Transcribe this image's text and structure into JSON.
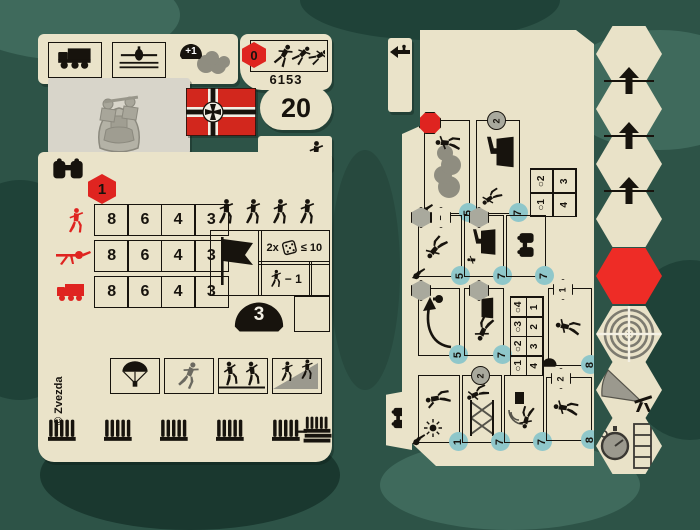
{
  "colors": {
    "background": "#2d5347",
    "camo_dark": "#1f4238",
    "camo_light": "#3f6a5c",
    "card": "#eae3c9",
    "red": "#df2420",
    "flag_red": "#d2271d",
    "ink": "#17130d",
    "teal_badge": "#8fc7ca",
    "icon_gray": "#8f8d80"
  },
  "left_card": {
    "transport_row": {
      "icons": [
        "truck",
        "air-transport",
        "camouflage"
      ],
      "camouflage_bonus": "+1"
    },
    "entrench": {
      "cost": "0"
    },
    "product_number": "6153",
    "points": "20",
    "flag": "german-war-flag",
    "photo": "machine-gun-team-miniature",
    "unit_class": "infantry-figure",
    "order_cost": "1",
    "fire_table": {
      "rows": [
        {
          "target": "infantry",
          "values": [
            "8",
            "6",
            "4",
            "3"
          ]
        },
        {
          "target": "machine-gun",
          "values": [
            "8",
            "6",
            "4",
            "3"
          ]
        },
        {
          "target": "vehicle",
          "values": [
            "8",
            "6",
            "4",
            "3"
          ]
        }
      ]
    },
    "squad_size_icons": 4,
    "morale": {
      "multiplier": "2x",
      "threshold": "≤ 10",
      "modifier": "− 1"
    },
    "defense": {
      "helmet_value": "3"
    },
    "ability_icons": [
      "parachute-drop",
      "advance",
      "climb-assault",
      "landing-ramp"
    ],
    "copyright": "© Zvezda",
    "ammo_row": {
      "clip_groups": 5,
      "crate": "ammo-crate"
    }
  },
  "right_card": {
    "top_tab_icon": "exit-arrow-soldier",
    "bottom_tab_icon": "binoculars",
    "action_boxes": [
      {
        "name": "smoke-screen",
        "marker": "red-octagon",
        "marker_value": "",
        "cost": "5"
      },
      {
        "name": "attack-mg-nest",
        "marker": "gray-round",
        "marker_value": "2",
        "cost": "7"
      },
      {
        "name": "charge",
        "marker": "hex-pair",
        "marker_value": "−",
        "cost": "5"
      },
      {
        "name": "occupy-mg-nest",
        "marker": "gray-hex",
        "marker_value": "",
        "cost": "7"
      },
      {
        "name": "observe",
        "marker": "none",
        "marker_value": "",
        "cost": "7"
      },
      {
        "name": "grenade-throw",
        "marker": "gray-hex",
        "marker_value": "",
        "cost": "5"
      },
      {
        "name": "crawl-assault",
        "marker": "gray-hex",
        "marker_value": "",
        "cost": "7"
      },
      {
        "name": "march",
        "marker": "hex-number",
        "marker_value": "1",
        "cost": "8"
      },
      {
        "name": "signal-flare",
        "marker": "none",
        "marker_value": "",
        "cost": "1"
      },
      {
        "name": "climb-obstacle",
        "marker": "gray-round",
        "marker_value": "2",
        "cost": "7"
      },
      {
        "name": "radio-contact",
        "marker": "none",
        "marker_value": "",
        "cost": "7"
      },
      {
        "name": "forced-march",
        "marker": "hex-number",
        "marker_value": "2",
        "cost": "8"
      }
    ],
    "range_tables": [
      {
        "headers": [
          "○1",
          "○2"
        ],
        "values": [
          "4",
          "3"
        ]
      },
      {
        "headers": [
          "○1",
          "○2",
          "○3",
          "○4"
        ],
        "values": [
          "4",
          "3",
          "2",
          "1"
        ]
      }
    ],
    "hex_track": {
      "plain_hex_count": 4,
      "arrow_count": 3,
      "hexes": [
        "move",
        "move",
        "move",
        "move",
        "red",
        "target",
        "fire-arc",
        "timer"
      ]
    }
  }
}
